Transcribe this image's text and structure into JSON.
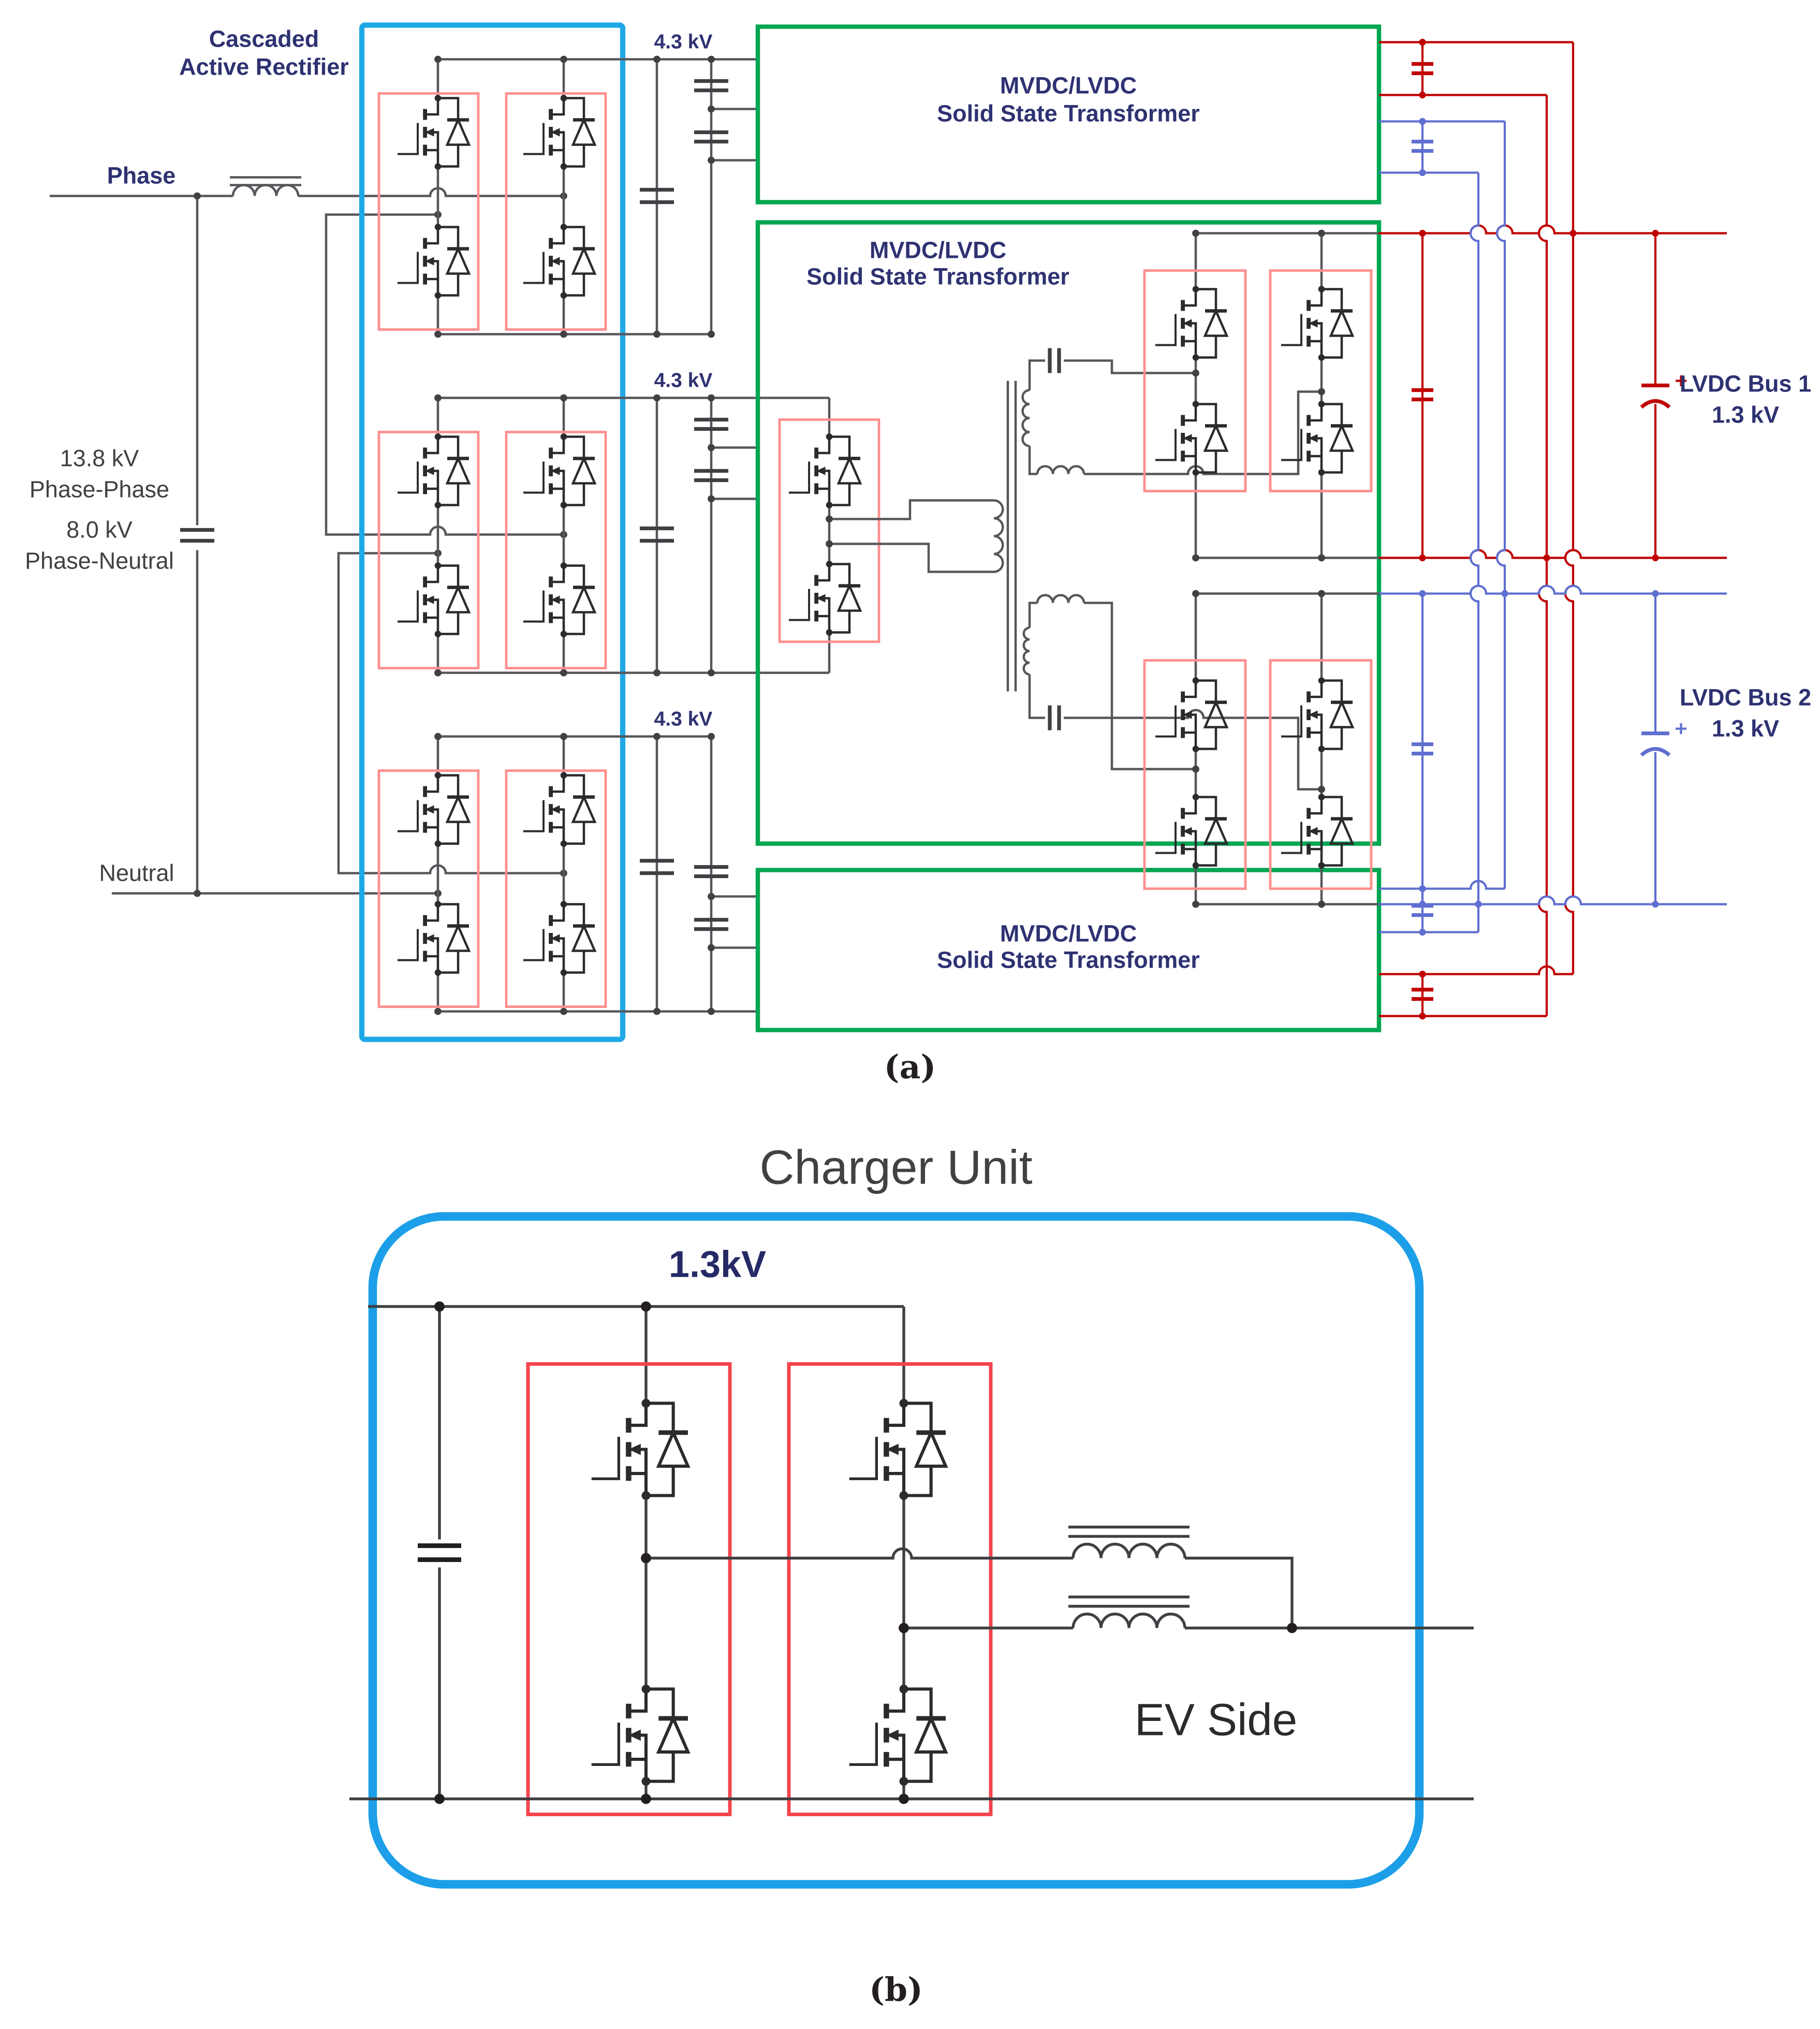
{
  "panel_a": {
    "caption": "(a)",
    "cascaded_label": [
      "Cascaded",
      "Active Rectifier"
    ],
    "phase_label": "Phase",
    "neutral_label": "Neutral",
    "source_labels": [
      "13.8 kV",
      "Phase-Phase",
      "8.0 kV",
      "Phase-Neutral"
    ],
    "dc_link_label": "4.3 kV",
    "sst_label": [
      "MVDC/LVDC",
      "Solid State Transformer"
    ],
    "bus1_label": [
      "LVDC Bus 1",
      "1.3 kV"
    ],
    "bus2_label": [
      "LVDC Bus 2",
      "1.3 kV"
    ]
  },
  "panel_b": {
    "caption": "(b)",
    "title": "Charger Unit",
    "dc_label": "1.3kV",
    "ev_label": "EV Side"
  },
  "colors": {
    "cascade_box": "#1fa8e6",
    "sst_box": "#00a651",
    "device_box_a": "#ff8f8f",
    "device_box_b": "#f4444c",
    "charger_box": "#1c9fe8",
    "wire": "#56575b",
    "bus1_red": "#c00000",
    "bus2_blue": "#5f6fd0",
    "label_navy": "#2e3272",
    "label_dark": "#414042"
  }
}
